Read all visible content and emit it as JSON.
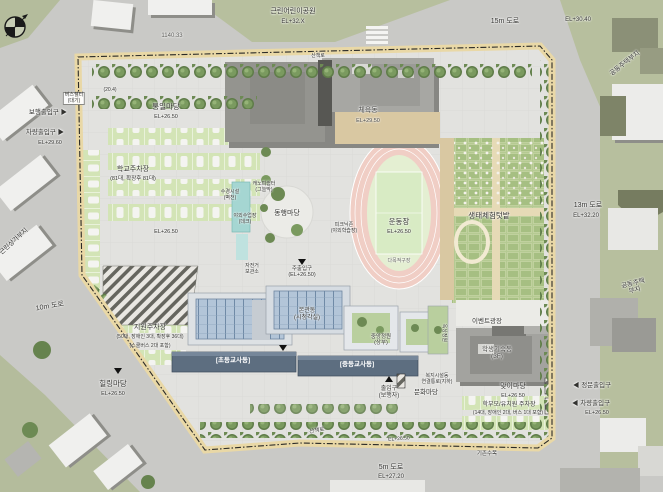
{
  "palette": {
    "road_gray": "#c9c9c6",
    "context_green": "#b7bf9e",
    "site_paving": "#e2e2df",
    "perimeter_path_tan": "#e9d8a6",
    "tree_green": "#6d8a54",
    "parking_green": "#d3e4b6",
    "track_pink": "#f0cec5",
    "field_green": "#e4efd2",
    "glass_roof_blue": "#5f7b99",
    "building_band_navy": "#5d6e80",
    "building_gray": "#a3a3a0",
    "water_teal": "#a5d6d2",
    "boundary_line": "#2a2a28"
  },
  "icons": {
    "compass": "north-arrow-icon"
  },
  "labels": [
    {
      "id": "road-15m",
      "text": "15m 도로",
      "x": 505,
      "y": 18,
      "fs": 7
    },
    {
      "id": "el-30-40",
      "text": "EL+30.40",
      "x": 578,
      "y": 17,
      "fs": 6
    },
    {
      "id": "road-13m",
      "text": "13m 도로",
      "x": 588,
      "y": 202,
      "fs": 7
    },
    {
      "id": "el-32-20",
      "text": "EL+32.20",
      "x": 586,
      "y": 213,
      "fs": 6
    },
    {
      "id": "road-10m",
      "text": "10m 도로",
      "x": 50,
      "y": 303,
      "fs": 7,
      "rot": -10
    },
    {
      "id": "road-5m",
      "text": "5m 도로",
      "x": 391,
      "y": 464,
      "fs": 7
    },
    {
      "id": "el-27-20",
      "text": "EL+27.20",
      "x": 391,
      "y": 474,
      "fs": 6
    },
    {
      "id": "dim-top",
      "text": "1140.33",
      "x": 172,
      "y": 33,
      "fs": 6,
      "color": "#5a5a56"
    },
    {
      "id": "park-name",
      "text": "근린어린이공원",
      "x": 293,
      "y": 8,
      "fs": 7
    },
    {
      "id": "park-el",
      "text": "EL+32.X",
      "x": 293,
      "y": 19,
      "fs": 6
    },
    {
      "id": "parcel-right-top",
      "text": "공동주택부지",
      "x": 625,
      "y": 60,
      "fs": 6.5,
      "rot": -38
    },
    {
      "id": "parcel-right-bottom",
      "text": "공동주택부지",
      "x": 634,
      "y": 280,
      "fs": 6.5,
      "rot": -14
    },
    {
      "id": "parcel-left",
      "text": "근린상가부지",
      "x": 14,
      "y": 238,
      "fs": 6.5,
      "rot": -42
    },
    {
      "id": "ped-entry-left",
      "text": "보행출입구 ▶",
      "x": 48,
      "y": 109,
      "fs": 6.5
    },
    {
      "id": "car-entry-left",
      "text": "차량출입구 ▶",
      "x": 45,
      "y": 129,
      "fs": 6.5
    },
    {
      "id": "el-29-60",
      "text": "EL+29.60",
      "x": 50,
      "y": 140,
      "fs": 5.5
    },
    {
      "id": "gate-main",
      "text": "◀ 정문출입구",
      "x": 592,
      "y": 382,
      "fs": 6.5
    },
    {
      "id": "gate-car",
      "text": "◀ 차량출입구",
      "x": 591,
      "y": 400,
      "fs": 6.5
    },
    {
      "id": "el-26-50-gate",
      "text": "EL+26.50",
      "x": 597,
      "y": 410,
      "fs": 5.5
    },
    {
      "id": "plaza-unity",
      "text": "통일마당",
      "x": 166,
      "y": 103,
      "fs": 7.5
    },
    {
      "id": "plaza-unity-el",
      "text": "EL+26.50",
      "x": 166,
      "y": 114,
      "fs": 5.5
    },
    {
      "id": "parking-school",
      "text": "학교주차장",
      "x": 133,
      "y": 166,
      "fs": 7
    },
    {
      "id": "parking-school-cnt",
      "text": "(81대, 확장후 81대)",
      "x": 133,
      "y": 176,
      "fs": 5.5
    },
    {
      "id": "el-26-50-mid",
      "text": "EL+26.50",
      "x": 166,
      "y": 229,
      "fs": 5.5
    },
    {
      "id": "bldg-gym",
      "text": "체육동",
      "x": 368,
      "y": 107,
      "fs": 7,
      "color": "#474744"
    },
    {
      "id": "bldg-gym-el",
      "text": "EL+29.50",
      "x": 368,
      "y": 118,
      "fs": 5.5,
      "color": "#474744"
    },
    {
      "id": "field",
      "text": "운동장",
      "x": 399,
      "y": 218,
      "fs": 7.5
    },
    {
      "id": "field-el",
      "text": "EL+26.50",
      "x": 399,
      "y": 229,
      "fs": 5.5
    },
    {
      "id": "court-note",
      "text": "다목적구장",
      "x": 399,
      "y": 259,
      "fs": 5,
      "color": "#6a6a66"
    },
    {
      "id": "garden-eco",
      "text": "생태체험텃밭",
      "x": 489,
      "y": 212,
      "fs": 7.5
    },
    {
      "id": "plaza-together",
      "text": "동행마당",
      "x": 287,
      "y": 210,
      "fs": 7
    },
    {
      "id": "water-feature",
      "text": "수경시설\n(벽천)",
      "x": 230,
      "y": 190,
      "fs": 5
    },
    {
      "id": "outdoor-class",
      "text": "야외수업장\n(데크)",
      "x": 245,
      "y": 214,
      "fs": 5
    },
    {
      "id": "picnic-zone",
      "text": "피크닉존\n(야외학습장)",
      "x": 344,
      "y": 223,
      "fs": 5
    },
    {
      "id": "canopy-rest",
      "text": "캐노피쉼터\n(그늘막)",
      "x": 264,
      "y": 182,
      "fs": 5
    },
    {
      "id": "main-entry",
      "text": "주출입구\n(EL+26.50)",
      "x": 302,
      "y": 266,
      "fs": 5.5
    },
    {
      "id": "bike-shed",
      "text": "자전거\n보관소",
      "x": 252,
      "y": 264,
      "fs": 5
    },
    {
      "id": "bldg-main",
      "text": "본관동\n(시청각실)",
      "x": 307,
      "y": 308,
      "fs": 6
    },
    {
      "id": "lib-court",
      "text": "중앙정원\n(상부)",
      "x": 381,
      "y": 334,
      "fs": 5.5
    },
    {
      "id": "roof-garden",
      "text": "옥상정원",
      "x": 443,
      "y": 330,
      "fs": 5,
      "rot": 90
    },
    {
      "id": "bldg-band-1",
      "text": "[초등교사동]",
      "x": 233,
      "y": 357,
      "fs": 6.5,
      "white": true
    },
    {
      "id": "bldg-band-2",
      "text": "[중등교사동]",
      "x": 357,
      "y": 361,
      "fs": 6.5,
      "white": true
    },
    {
      "id": "bldg-dorm",
      "text": "학생기숙동\n(3F)",
      "x": 497,
      "y": 346,
      "fs": 6.5,
      "color": "#474744"
    },
    {
      "id": "event-plaza",
      "text": "이벤트광장",
      "x": 487,
      "y": 318,
      "fs": 6.5
    },
    {
      "id": "welfare-link",
      "text": "복지시설동\n연결통로(지하)",
      "x": 437,
      "y": 374,
      "fs": 5
    },
    {
      "id": "plaza-welcome",
      "text": "맞이마당",
      "x": 513,
      "y": 383,
      "fs": 7
    },
    {
      "id": "plaza-welcome-el",
      "text": "EL+26.50",
      "x": 513,
      "y": 393,
      "fs": 5.5
    },
    {
      "id": "parking-parent",
      "text": "학부모/유치원 주차장",
      "x": 509,
      "y": 402,
      "fs": 6
    },
    {
      "id": "parking-parent-cnt",
      "text": "(14대, 장애인 2대, 버스 1대 포함)",
      "x": 508,
      "y": 411,
      "fs": 5
    },
    {
      "id": "entry-walk",
      "text": "출입구\n(보행자)",
      "x": 389,
      "y": 386,
      "fs": 6
    },
    {
      "id": "plaza-culture",
      "text": "문화마당",
      "x": 426,
      "y": 389,
      "fs": 6.5
    },
    {
      "id": "parking-support",
      "text": "지원주차장",
      "x": 150,
      "y": 324,
      "fs": 7
    },
    {
      "id": "parking-support-cnt",
      "text": "(50대, 장애인 3대, 확장후 36대)",
      "x": 150,
      "y": 335,
      "fs": 5
    },
    {
      "id": "parking-support-cnt2",
      "text": "(스쿨버스 2대 포함)",
      "x": 150,
      "y": 344,
      "fs": 5
    },
    {
      "id": "plaza-healing",
      "text": "힐링마당",
      "x": 113,
      "y": 380,
      "fs": 7.5
    },
    {
      "id": "plaza-healing-el",
      "text": "EL+26.50",
      "x": 113,
      "y": 391,
      "fs": 5.5
    },
    {
      "id": "trail-bottom",
      "text": "산책로",
      "x": 317,
      "y": 428,
      "fs": 5.5,
      "rot": -10
    },
    {
      "id": "el-26-50-botpath",
      "text": "EL+26.50",
      "x": 399,
      "y": 437,
      "fs": 5,
      "rot": -4
    },
    {
      "id": "existing-trees",
      "text": "기존수목",
      "x": 487,
      "y": 451,
      "fs": 5.5
    },
    {
      "id": "bus-shelter",
      "text": "버스쉘터\n(대기)",
      "x": 74,
      "y": 92,
      "fs": 5,
      "chip": true
    },
    {
      "id": "num-20-4",
      "text": "(20.4)",
      "x": 110,
      "y": 88,
      "fs": 5
    },
    {
      "id": "trail-top",
      "text": "산책로",
      "x": 318,
      "y": 54,
      "fs": 5
    }
  ]
}
